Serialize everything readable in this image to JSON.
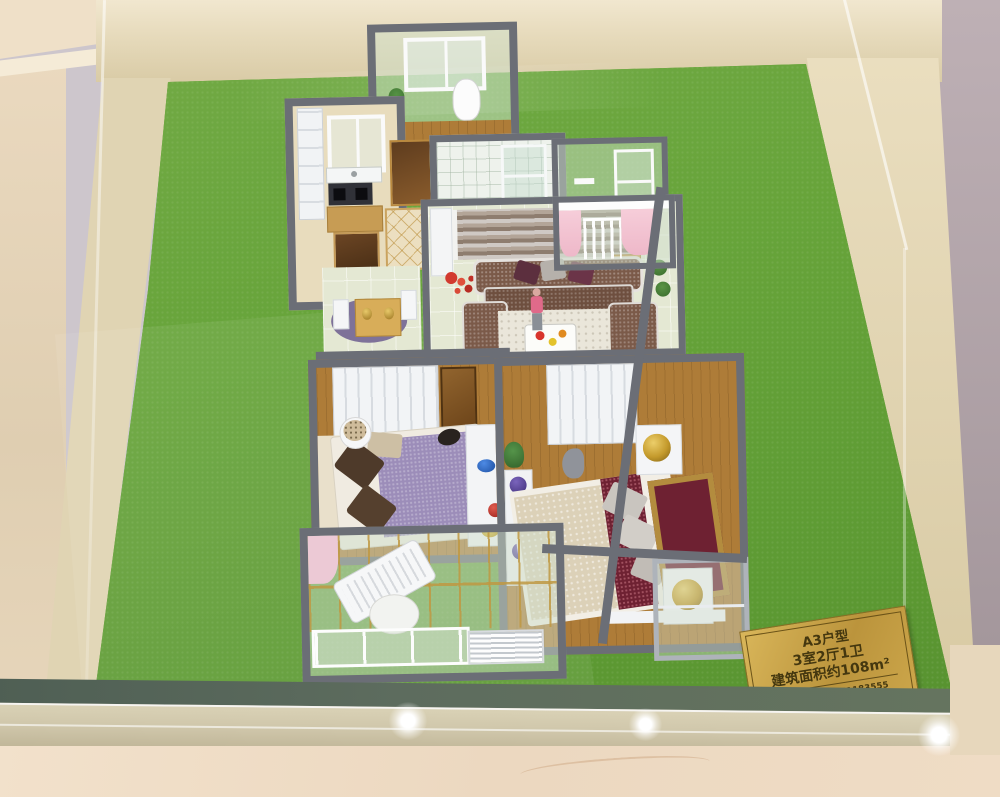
{
  "scene": {
    "type": "photograph",
    "subject": "Miniature apartment floor-plan scale model displayed in a glass case on green felt",
    "colors": {
      "felt_green": "#67a33c",
      "marble_frame": "#e3d7b7",
      "wall_mauve": "#b3a5aa",
      "wall_lavender": "#cdc6cc",
      "model_wall_gray": "#6b6e76",
      "wood_floor": "#ae7c38",
      "plaque_gold": "#c6a045",
      "plaque_text": "#44370f",
      "front_marble": "#efdec8"
    }
  },
  "plaque": {
    "title": "A3户型",
    "layout": "3室2厅1卫",
    "area": "建筑面积约108m²",
    "maker": "尚美模型：13851183555"
  }
}
